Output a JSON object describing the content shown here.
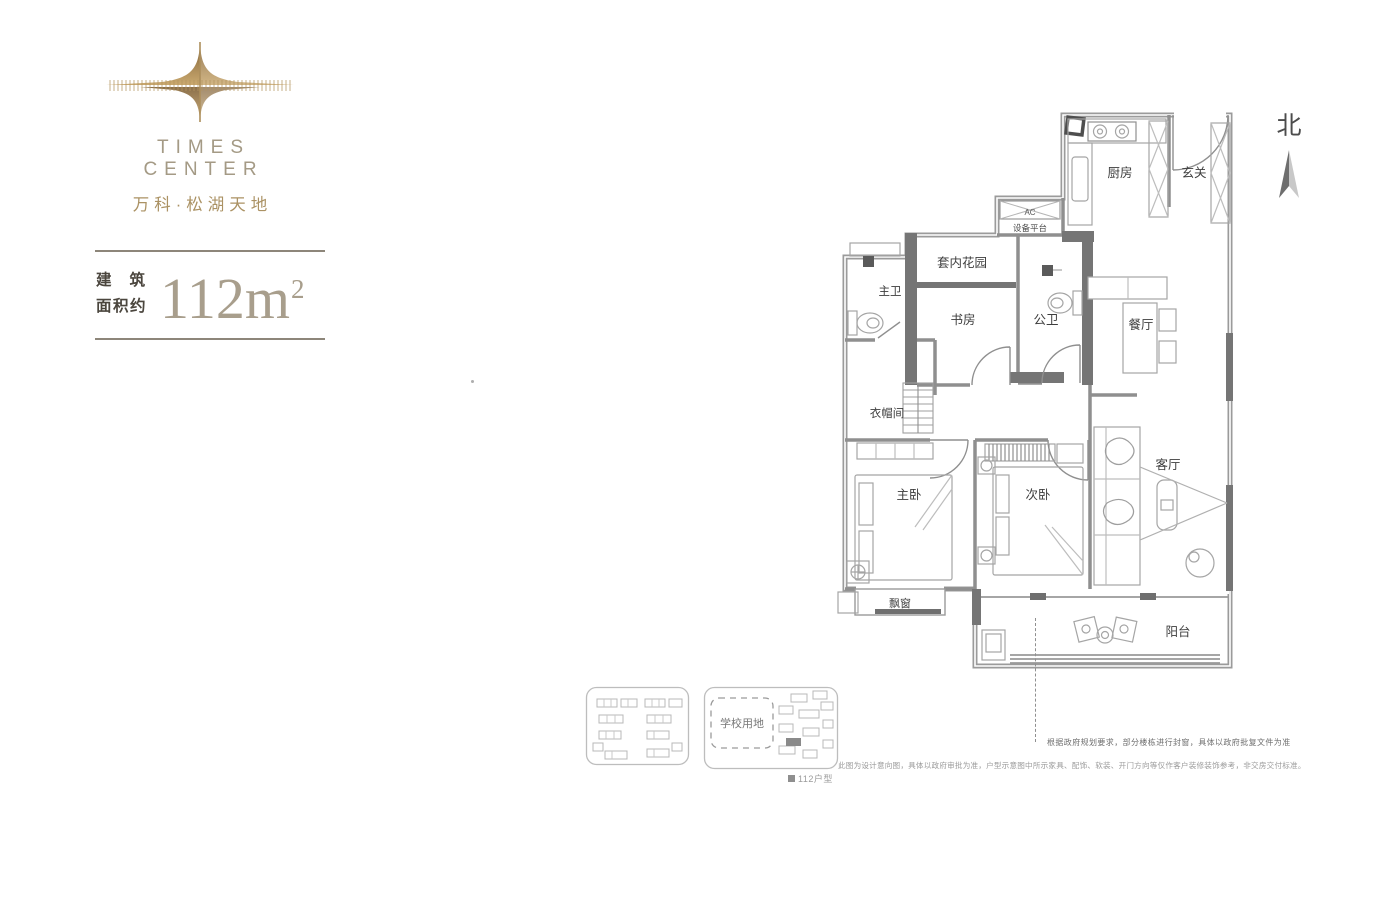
{
  "brand": {
    "logo_title": "TIMES CENTER",
    "logo_subtitle": "万科·松湖天地",
    "gold": "#ab9264"
  },
  "area_badge": {
    "line1": "建筑",
    "line2": "面积约",
    "value": "112m",
    "sup": "2"
  },
  "compass": {
    "label": "北"
  },
  "floor_plan": {
    "labels": {
      "kitchen": "厨房",
      "foyer": "玄关",
      "ac": "AC",
      "equipment_platform": "设备平台",
      "inner_garden": "套内花园",
      "master_bath": "主卫",
      "study": "书房",
      "guest_bath": "公卫",
      "dining": "餐厅",
      "cloakroom": "衣帽间",
      "master_bedroom": "主卧",
      "second_bedroom": "次卧",
      "living_room": "客厅",
      "bay_window": "飘窗",
      "balcony": "阳台"
    }
  },
  "site_plan": {
    "school_label": "学校用地",
    "legend_label": "112户型"
  },
  "notes": {
    "window_note": "根据政府规划要求，部分楼栋进行封窗，具体以政府批复文件为准",
    "disclaimer": "此图为设计意向图，具体以政府审批为准，户型示意图中所示家具、配饰、软装、开门方向等仅作客户装修装饰参考，非交房交付标准。"
  }
}
